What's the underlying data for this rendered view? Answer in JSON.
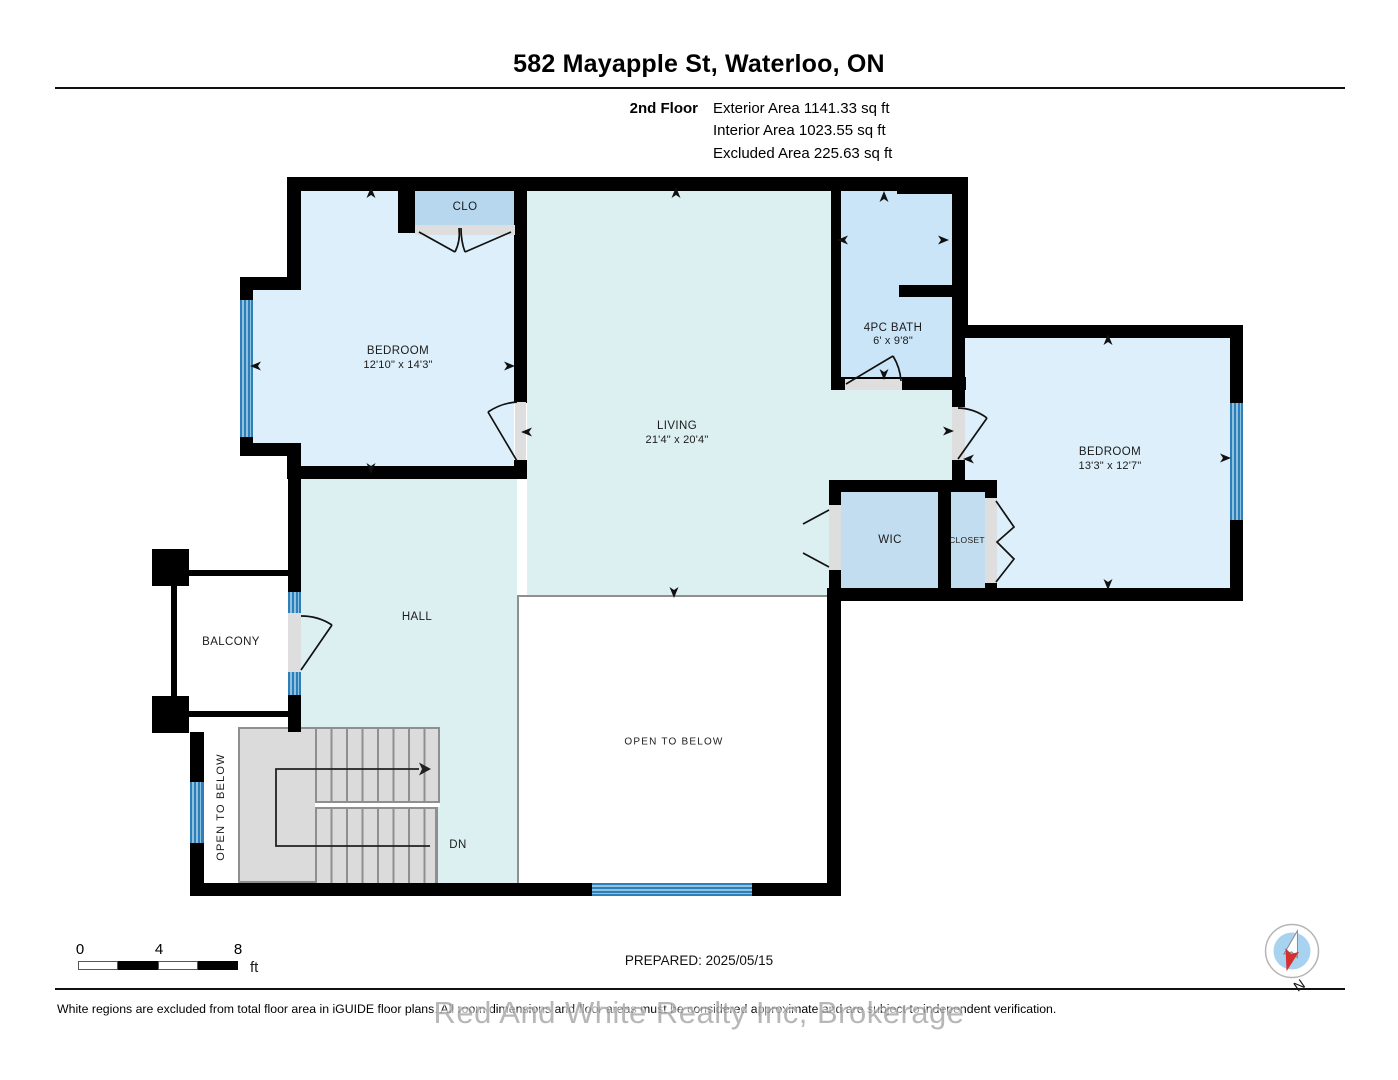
{
  "header": {
    "title": "582 Mayapple St, Waterloo, ON",
    "floor_label": "2nd Floor",
    "exterior_area": "Exterior Area 1141.33 sq ft",
    "interior_area": "Interior Area 1023.55 sq ft",
    "excluded_area": "Excluded Area 225.63 sq ft"
  },
  "rooms": {
    "clo": {
      "label": "CLO"
    },
    "bedroom1": {
      "label": "BEDROOM",
      "dims": "12'10\" x 14'3\""
    },
    "living": {
      "label": "LIVING",
      "dims": "21'4\" x 20'4\""
    },
    "bath": {
      "label": "4PC BATH",
      "dims": "6' x 9'8\""
    },
    "bedroom2": {
      "label": "BEDROOM",
      "dims": "13'3\" x 12'7\""
    },
    "wic": {
      "label": "WIC"
    },
    "closet": {
      "label": "CLOSET"
    },
    "hall": {
      "label": "HALL"
    },
    "balcony": {
      "label": "BALCONY"
    },
    "open_below_stair": {
      "label": "OPEN TO BELOW"
    },
    "open_below_main": {
      "label": "OPEN TO BELOW"
    },
    "stairs_dn": {
      "label": "DN"
    }
  },
  "scale_bar": {
    "tick0": "0",
    "tick4": "4",
    "tick8": "8",
    "unit": "ft"
  },
  "footer": {
    "prepared": "PREPARED: 2025/05/15",
    "disclaimer": "White regions are excluded from total floor area in iGUIDE floor plans. All room dimensions and floor areas must be considered approximate and are subject to independent verification.",
    "watermark": "Red And White Realty Inc, Brokerage",
    "compass_north": "N"
  },
  "colors": {
    "wall": "#000000",
    "bedroom_fill": "#ddeffa",
    "living_fill": "#dcf0f1",
    "bath_fill": "#cbe5f8",
    "wic_fill": "#c2dcf0",
    "clo_fill": "#b7d7ee",
    "stair_fill": "#dbdbdb",
    "railing": "#8f8f8f",
    "sill": "#dedede",
    "window_line": "#2e7eb8",
    "window_light": "#8fc1e0",
    "watermark": "#a6a6a6",
    "compass_red": "#d43030",
    "compass_blue": "#a7d3f0"
  }
}
